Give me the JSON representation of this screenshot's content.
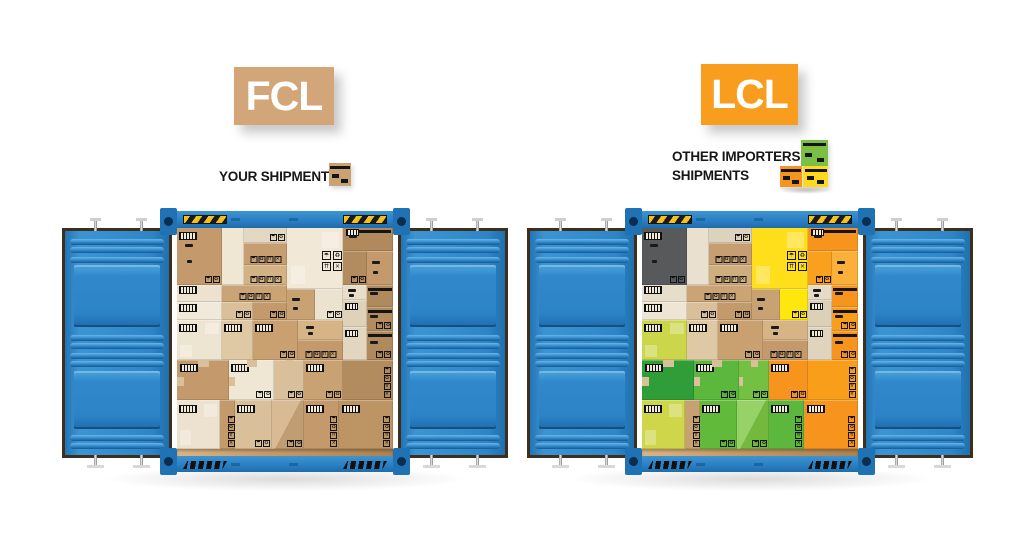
{
  "fcl": {
    "label": "FCL",
    "label_bg": "#d2a679",
    "legend": "YOUR SHIPMENT",
    "legend_icon": "single-cardboard-box",
    "icon_color": "#c9a274"
  },
  "lcl": {
    "label": "LCL",
    "label_bg": "#f89d1d",
    "legend_line1": "OTHER IMPORTERS'",
    "legend_line2": "SHIPMENTS",
    "legend_icon": "stacked-colored-boxes",
    "icon_colors": {
      "top_green": "#7cc043",
      "bottom_left_orange": "#f7941e",
      "bottom_right_yellow": "#ffd91e"
    }
  },
  "container_colors": {
    "blue": "#2e86c8",
    "blue_dark": "#1d6cad",
    "blue_light": "#57a7dc",
    "corner_block": "#1f72b4",
    "corner_hole": "#0b2e4e",
    "hazard_yellow": "#f5c21d",
    "door_border": "#3e2f1d",
    "interior_bg": "#efe6d6",
    "floor": "#c69c6a"
  },
  "symbol_glyphs": [
    "☂",
    "♻",
    "⇈",
    "×"
  ],
  "box_layout": [
    {
      "x": 0,
      "y": 0,
      "w": 21,
      "h": 26,
      "dec": [
        "bc",
        "dash",
        "sym-sm"
      ]
    },
    {
      "x": 21,
      "y": 0,
      "w": 10,
      "h": 26,
      "dec": []
    },
    {
      "x": 31,
      "y": 0,
      "w": 20,
      "h": 7,
      "dec": [
        "sym-sm"
      ]
    },
    {
      "x": 31,
      "y": 7,
      "w": 20,
      "h": 10,
      "dec": [
        "sym-row"
      ]
    },
    {
      "x": 31,
      "y": 17,
      "w": 20,
      "h": 9,
      "dec": [
        "sym-row"
      ]
    },
    {
      "x": 51,
      "y": 0,
      "w": 26,
      "h": 28,
      "dec": [
        "sym-2x2",
        "patch"
      ]
    },
    {
      "x": 77,
      "y": 0,
      "w": 23,
      "h": 11,
      "dec": [
        "tape",
        "bc-sm"
      ]
    },
    {
      "x": 77,
      "y": 11,
      "w": 11,
      "h": 15,
      "dec": [
        "sym-sm"
      ]
    },
    {
      "x": 88,
      "y": 11,
      "w": 12,
      "h": 15,
      "dec": [
        "dash"
      ]
    },
    {
      "x": 0,
      "y": 26,
      "w": 21,
      "h": 8,
      "dec": [
        "bc"
      ]
    },
    {
      "x": 0,
      "y": 34,
      "w": 21,
      "h": 8,
      "dec": [
        "bc"
      ]
    },
    {
      "x": 21,
      "y": 26,
      "w": 30,
      "h": 8,
      "dec": [
        "sym-row"
      ]
    },
    {
      "x": 21,
      "y": 34,
      "w": 14,
      "h": 8,
      "dec": [
        "sym-sm"
      ]
    },
    {
      "x": 35,
      "y": 34,
      "w": 16,
      "h": 8,
      "dec": [
        "sym-sm"
      ]
    },
    {
      "x": 51,
      "y": 28,
      "w": 13,
      "h": 14,
      "dec": [
        "dash"
      ]
    },
    {
      "x": 64,
      "y": 28,
      "w": 13,
      "h": 14,
      "dec": [
        "sym-sm"
      ]
    },
    {
      "x": 77,
      "y": 26,
      "w": 11,
      "h": 7,
      "dec": [
        "dash"
      ]
    },
    {
      "x": 77,
      "y": 33,
      "w": 11,
      "h": 12,
      "dec": [
        "bc-sm"
      ]
    },
    {
      "x": 88,
      "y": 26,
      "w": 12,
      "h": 10,
      "dec": [
        "tape"
      ]
    },
    {
      "x": 88,
      "y": 36,
      "w": 12,
      "h": 11,
      "dec": [
        "tape",
        "sym-sm"
      ]
    },
    {
      "x": 0,
      "y": 42,
      "w": 21,
      "h": 18,
      "dec": [
        "bc",
        "patch"
      ]
    },
    {
      "x": 21,
      "y": 42,
      "w": 14,
      "h": 18,
      "dec": [
        "bc"
      ]
    },
    {
      "x": 35,
      "y": 42,
      "w": 21,
      "h": 18,
      "dec": [
        "bc",
        "sym-sm"
      ]
    },
    {
      "x": 56,
      "y": 42,
      "w": 21,
      "h": 9,
      "dec": [
        "dash"
      ]
    },
    {
      "x": 56,
      "y": 51,
      "w": 21,
      "h": 9,
      "dec": [
        "sym-row"
      ]
    },
    {
      "x": 77,
      "y": 45,
      "w": 11,
      "h": 15,
      "dec": [
        "bc-sm"
      ]
    },
    {
      "x": 88,
      "y": 47,
      "w": 12,
      "h": 13,
      "dec": [
        "tape",
        "sym-sm"
      ]
    },
    {
      "x": 0,
      "y": 60,
      "w": 24,
      "h": 18,
      "dec": [
        "bc",
        "notch"
      ]
    },
    {
      "x": 24,
      "y": 60,
      "w": 21,
      "h": 18,
      "dec": [
        "bc",
        "sym-sm",
        "notch"
      ]
    },
    {
      "x": 45,
      "y": 60,
      "w": 14,
      "h": 18,
      "dec": [
        "sym-sm",
        "notch"
      ]
    },
    {
      "x": 59,
      "y": 60,
      "w": 18,
      "h": 18,
      "dec": [
        "bc",
        "sym-sm"
      ]
    },
    {
      "x": 77,
      "y": 60,
      "w": 23,
      "h": 18,
      "dec": [
        "sym-col"
      ]
    },
    {
      "x": 0,
      "y": 78,
      "w": 20,
      "h": 22,
      "dec": [
        "bc",
        "patch"
      ]
    },
    {
      "x": 20,
      "y": 78,
      "w": 7,
      "h": 22,
      "dec": [
        "sym-col"
      ]
    },
    {
      "x": 27,
      "y": 78,
      "w": 17,
      "h": 22,
      "dec": [
        "bc",
        "sym-sm"
      ]
    },
    {
      "x": 44,
      "y": 78,
      "w": 15,
      "h": 22,
      "dec": [
        "diag",
        "sym-sm"
      ]
    },
    {
      "x": 59,
      "y": 78,
      "w": 16,
      "h": 22,
      "dec": [
        "bc",
        "sym-col"
      ]
    },
    {
      "x": 75,
      "y": 78,
      "w": 25,
      "h": 22,
      "dec": [
        "bc",
        "sym-col"
      ]
    }
  ],
  "fcl_box_colors": [
    "#c49a6c",
    "#efe6d4",
    "#e4d8c2",
    "#c79e71",
    "#d3b384",
    "#f1e8d7",
    "#b08a5c",
    "#b28c5e",
    "#c49a6c",
    "#ece2cf",
    "#f1e9d9",
    "#cba476",
    "#d9c09a",
    "#c39a6c",
    "#c9a274",
    "#ece2d0",
    "#e8ddc9",
    "#dfd2ba",
    "#b08a5c",
    "#b28c5e",
    "#eee4d2",
    "#dfc9a4",
    "#c9a070",
    "#d6b485",
    "#c49a6c",
    "#e3d6c0",
    "#b08a5c",
    "#c49a6c",
    "#efe6d4",
    "#d9c09a",
    "#c9a274",
    "#b28c5e",
    "#ece2cf",
    "#c39a6c",
    "#d9c09a",
    "#cfa97a",
    "#c49a6c",
    "#bd9463"
  ],
  "lcl_box_colors": [
    "#58595b",
    "#e9e0d0",
    "#ddd2bc",
    "#c79e71",
    "#cfae7e",
    "#ffdf1c",
    "#f7941e",
    "#f9a11f",
    "#fbb03b",
    "#e7ddcb",
    "#eee5d4",
    "#cba476",
    "#d9c09a",
    "#c39a6c",
    "#c9a274",
    "#fee70c",
    "#e6dbc7",
    "#ddd0b8",
    "#f7941e",
    "#f89e1b",
    "#ccd64b",
    "#dfc9a4",
    "#c9a070",
    "#d6b485",
    "#c49a6c",
    "#e1d4be",
    "#f7941e",
    "#2f9e38",
    "#5cb83c",
    "#74c043",
    "#f7941e",
    "#f89e1b",
    "#cfd649",
    "#c8a173",
    "#62ba3a",
    "#7dc742",
    "#5cb83c",
    "#f7941e"
  ]
}
